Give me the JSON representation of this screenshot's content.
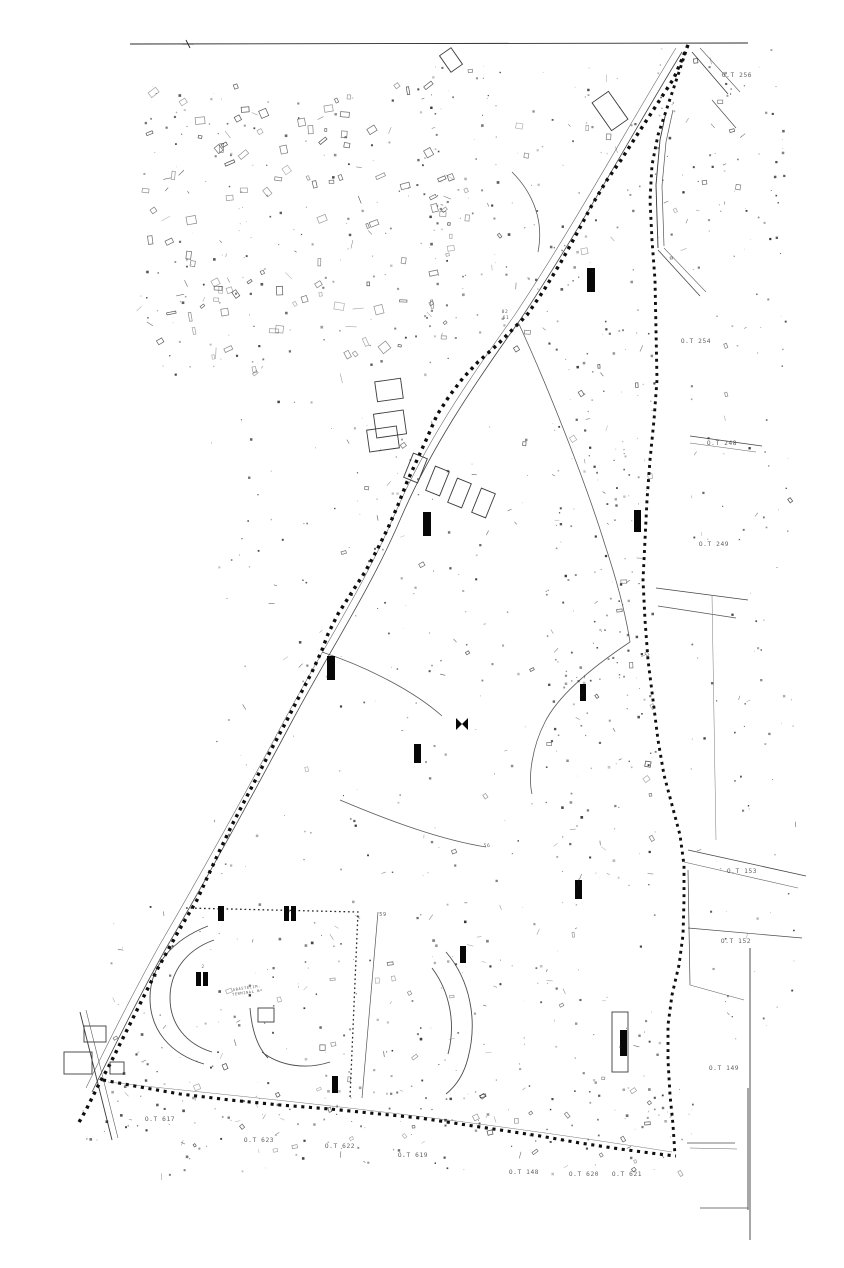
{
  "page": {
    "background": "#ffffff",
    "ink": "#0e0e0e",
    "road_color": "#3a3a3a",
    "label_color": "#4a4a4a"
  },
  "map": {
    "seed": 20240711,
    "boundaries": {
      "top_line": "M130,44 L748,43",
      "top_tick": "M186,40 L190,48 M182,44 L194,44",
      "main_diagonal": "M688,45 L674,78 L652,112 L637,135 L621,160 L607,180 L592,205 L576,235 L561,262 L544,290 L527,315 L512,330 L497,345 L478,362 L463,378 L450,395 L437,415 L427,438 L417,460 L407,482 L398,505 L388,528 L377,550 L365,572 L352,592 L338,614 L328,634 L322,650 L312,672 L300,695 L286,722 L272,748 L258,775 L245,800 L232,825 L219,852 L207,878 L197,900 L188,915 L178,932 L168,950 L158,968 L148,988 L138,1008 L128,1028 L118,1048 L108,1068 L100,1082 L93,1096 L86,1110 L78,1124",
      "right_edge": "M688,45 L678,75 L668,105 L658,135 L652,165 L650,200 L652,240 L655,280 L656,330 L657,380 L654,420 L650,460 L647,500 L645,540 L643,580 L645,620 L648,660 L653,700 L658,740 L664,775 L672,805 L680,835 L684,865 L684,900 L683,935 L679,965 L672,995 L668,1025 L668,1060 L670,1095 L673,1125 L675,1155",
      "bottom_edge": "M103,1080 L140,1087 L180,1094 L230,1100 L280,1105 L330,1109 L380,1114 L420,1118 L460,1124 L500,1130 L540,1136 L580,1143 L620,1149 L658,1154 L676,1156",
      "stadium_fence": "M186,908 L358,912 L350,1098"
    },
    "roads": [
      {
        "name": "diagonal-road-west-1",
        "d": "M682,52 C640,120 580,230 520,320 C470,390 430,450 400,520 C370,590 330,650 290,725 C250,800 200,890 165,950 C140,995 110,1055 92,1092",
        "w": 0.8,
        "c": "#474747"
      },
      {
        "name": "diagonal-road-west-2",
        "d": "M676,48 C634,116 574,226 514,316 C464,386 424,446 394,516 C364,586 324,646 284,721 C244,796 194,886 159,946 C134,991 104,1051 86,1088",
        "w": 0.6,
        "c": "#6a6a6a"
      },
      {
        "name": "right-road-vert-1",
        "d": "M666,112 L660,140 L656,185 L658,248",
        "w": 0.9,
        "c": "#3a3a3a"
      },
      {
        "name": "right-road-vert-2",
        "d": "M673,110 L666,142 L662,186 L664,246",
        "w": 0.7,
        "c": "#555555"
      },
      {
        "name": "right-road-bend-1",
        "d": "M658,250 L700,296",
        "w": 0.8,
        "c": "#4a4a4a"
      },
      {
        "name": "right-road-bend-2",
        "d": "M664,248 L706,292",
        "w": 0.6,
        "c": "#666666"
      },
      {
        "name": "topright-diag-1",
        "d": "M692,52 L728,94",
        "w": 0.8,
        "c": "#3f3f3f"
      },
      {
        "name": "topright-diag-2",
        "d": "M700,48 L740,92",
        "w": 0.6,
        "c": "#5f5f5f"
      },
      {
        "name": "topright-diag-3",
        "d": "M712,100 L736,128",
        "w": 0.7,
        "c": "#4f4f4f"
      },
      {
        "name": "street-248-1",
        "d": "M690,436 L762,446",
        "w": 0.8,
        "c": "#454545"
      },
      {
        "name": "street-248-2",
        "d": "M690,443 L756,452",
        "w": 0.6,
        "c": "#656565"
      },
      {
        "name": "street-249-fork-1",
        "d": "M656,588 L748,600",
        "w": 0.8,
        "c": "#454545"
      },
      {
        "name": "street-249-fork-2",
        "d": "M658,606 L736,618",
        "w": 0.7,
        "c": "#555555"
      },
      {
        "name": "right-vert-mid",
        "d": "M712,595 L716,840",
        "w": 0.5,
        "c": "#777777"
      },
      {
        "name": "street-153-diag-1",
        "d": "M688,850 L806,876",
        "w": 0.8,
        "c": "#454545"
      },
      {
        "name": "street-153-diag-2",
        "d": "M684,862 L798,888",
        "w": 0.6,
        "c": "#606060"
      },
      {
        "name": "street-152-vert",
        "d": "M688,870 L690,985",
        "w": 0.7,
        "c": "#4d4d4d"
      },
      {
        "name": "street-152-horiz",
        "d": "M688,928 L802,938",
        "w": 0.7,
        "c": "#4d4d4d"
      },
      {
        "name": "street-152-diag",
        "d": "M690,985 L744,1000",
        "w": 0.6,
        "c": "#606060"
      },
      {
        "name": "neatline-right-vert",
        "d": "M750,948 L750,1240",
        "w": 0.9,
        "c": "#3c3c3c"
      },
      {
        "name": "frame-h1",
        "d": "M687,1143 L735,1143",
        "w": 0.8,
        "c": "#4a4a4a"
      },
      {
        "name": "frame-h2",
        "d": "M690,1148 L737,1149",
        "w": 0.6,
        "c": "#6a6a6a"
      },
      {
        "name": "frame-h3",
        "d": "M700,1208 L748,1208",
        "w": 0.8,
        "c": "#4a4a4a"
      },
      {
        "name": "frame-v",
        "d": "M748,1088 L748,1210",
        "w": 0.9,
        "c": "#3c3c3c"
      },
      {
        "name": "bottomleft-cross-1",
        "d": "M80,1012 L112,1140",
        "w": 0.9,
        "c": "#3c3c3c"
      },
      {
        "name": "bottomleft-cross-2",
        "d": "M86,1010 L118,1138",
        "w": 0.6,
        "c": "#606060"
      },
      {
        "name": "bottom-echo",
        "d": "M108,1082 C250,1098 420,1112 672,1152",
        "w": 0.5,
        "c": "#787878"
      },
      {
        "name": "stadium-cut-line",
        "d": "M378,912 L362,1098",
        "w": 0.7,
        "c": "#555555"
      }
    ],
    "curves": [
      {
        "name": "stream-upper",
        "d": "M518,322 C545,380 585,480 605,545 C615,575 625,610 630,642"
      },
      {
        "name": "stream-lower",
        "d": "M630,642 C600,662 560,692 545,722 C532,747 528,777 532,794"
      },
      {
        "name": "path-mid-1",
        "d": "M322,652 C370,668 415,692 442,716"
      },
      {
        "name": "path-mid-2",
        "d": "M340,800 C392,822 442,840 486,847"
      },
      {
        "name": "path-top",
        "d": "M512,172 C534,194 544,222 538,252"
      }
    ],
    "stadium_arcs": [
      "M208,926 C172,940 150,966 150,998 C150,1030 170,1054 204,1064",
      "M214,940 C186,950 170,972 170,998 C170,1024 186,1044 212,1052",
      "M446,952 C470,980 478,1020 468,1058 C464,1074 456,1086 446,1094",
      "M432,968 C450,992 456,1024 448,1054",
      "M262,1052 C280,1066 306,1070 330,1062",
      "M250,1008 C252,1032 258,1048 268,1058"
    ],
    "building_bars": [
      [
        587,
        268,
        8,
        24
      ],
      [
        423,
        512,
        8,
        24
      ],
      [
        634,
        510,
        7,
        22
      ],
      [
        327,
        656,
        8,
        24
      ],
      [
        580,
        684,
        6,
        17
      ],
      [
        414,
        744,
        7,
        19
      ],
      [
        575,
        880,
        7,
        19
      ],
      [
        284,
        906,
        5,
        15
      ],
      [
        291,
        906,
        5,
        15
      ],
      [
        218,
        906,
        6,
        15
      ],
      [
        196,
        972,
        5,
        14
      ],
      [
        203,
        972,
        5,
        14
      ],
      [
        460,
        946,
        6,
        17
      ],
      [
        332,
        1076,
        6,
        17
      ],
      [
        620,
        1030,
        7,
        26
      ]
    ],
    "bowtie": {
      "x": 462,
      "y": 724,
      "half": 6,
      "spread": 6
    },
    "outline_buildings": [
      {
        "x": 376,
        "y": 380,
        "w": 26,
        "h": 20,
        "r": -8
      },
      {
        "x": 375,
        "y": 412,
        "w": 30,
        "h": 24,
        "r": -8
      },
      {
        "x": 368,
        "y": 428,
        "w": 30,
        "h": 22,
        "r": -8
      },
      {
        "x": 408,
        "y": 455,
        "w": 15,
        "h": 26,
        "r": 22
      },
      {
        "x": 430,
        "y": 468,
        "w": 15,
        "h": 26,
        "r": 22
      },
      {
        "x": 452,
        "y": 480,
        "w": 15,
        "h": 26,
        "r": 22
      },
      {
        "x": 476,
        "y": 490,
        "w": 15,
        "h": 26,
        "r": 22
      },
      {
        "x": 84,
        "y": 1026,
        "w": 22,
        "h": 16,
        "r": 0
      },
      {
        "x": 64,
        "y": 1052,
        "w": 28,
        "h": 22,
        "r": 0
      },
      {
        "x": 110,
        "y": 1062,
        "w": 14,
        "h": 12,
        "r": 0
      },
      {
        "x": 258,
        "y": 1008,
        "w": 16,
        "h": 14,
        "r": 0
      },
      {
        "x": 612,
        "y": 1012,
        "w": 16,
        "h": 60,
        "r": 0
      },
      {
        "x": 444,
        "y": 50,
        "w": 14,
        "h": 20,
        "r": -35
      },
      {
        "x": 600,
        "y": 94,
        "w": 20,
        "h": 34,
        "r": -35
      }
    ],
    "labels": [
      {
        "name": "parcel-label-ot-256",
        "text": "O.T 256",
        "x": 737,
        "y": 77,
        "fs": 6.2
      },
      {
        "name": "parcel-label-ot-254",
        "text": "O.T 254",
        "x": 696,
        "y": 343,
        "fs": 6.2
      },
      {
        "name": "parcel-label-ot-248",
        "text": "O.T 248",
        "x": 722,
        "y": 445,
        "fs": 6.2
      },
      {
        "name": "parcel-label-ot-249",
        "text": "O.T 249",
        "x": 714,
        "y": 546,
        "fs": 6.2
      },
      {
        "name": "parcel-label-ot-153",
        "text": "O.T 153",
        "x": 742,
        "y": 873,
        "fs": 6.2
      },
      {
        "name": "parcel-label-ot-152",
        "text": "O.T 152",
        "x": 736,
        "y": 943,
        "fs": 6.2
      },
      {
        "name": "parcel-label-ot-149",
        "text": "O.T 149",
        "x": 724,
        "y": 1070,
        "fs": 6.2
      },
      {
        "name": "parcel-label-ot-617",
        "text": "O.T 617",
        "x": 160,
        "y": 1121,
        "fs": 6.2
      },
      {
        "name": "parcel-label-ot-623",
        "text": "O.T 623",
        "x": 259,
        "y": 1142,
        "fs": 6.2
      },
      {
        "name": "parcel-label-ot-622",
        "text": "O.T 622",
        "x": 340,
        "y": 1148,
        "fs": 6.2
      },
      {
        "name": "parcel-label-ot-619",
        "text": "O.T 619",
        "x": 413,
        "y": 1157,
        "fs": 6.2
      },
      {
        "name": "parcel-label-ot-148",
        "text": "O.T 148",
        "x": 524,
        "y": 1174,
        "fs": 6.2
      },
      {
        "name": "parcel-label-ot-620",
        "text": "O.T 620",
        "x": 584,
        "y": 1176,
        "fs": 6.2
      },
      {
        "name": "parcel-label-ot-621",
        "text": "O.T 621",
        "x": 627,
        "y": 1176,
        "fs": 6.2
      }
    ],
    "tiny_labels": [
      {
        "name": "plot-number-02",
        "text": "02",
        "x": 505,
        "y": 313,
        "fs": 4.6
      },
      {
        "name": "plot-number-61",
        "text": "61",
        "x": 506,
        "y": 319,
        "fs": 4.6
      },
      {
        "name": "plot-number-59",
        "text": "59",
        "x": 383,
        "y": 916,
        "fs": 5.2
      },
      {
        "name": "plot-number-56",
        "text": "56",
        "x": 487,
        "y": 847,
        "fs": 4.6
      },
      {
        "name": "plot-number-2",
        "text": "2",
        "x": 203,
        "y": 968,
        "fs": 4.2
      }
    ],
    "stadium_note": {
      "line1": "ABASTECIM.",
      "line2": "TERMINAL Nº",
      "x": 247,
      "y": 989,
      "fs": 3.7,
      "rot": -8
    },
    "noise_regions": [
      {
        "x": 140,
        "y": 85,
        "w": 310,
        "h": 290,
        "count": 300,
        "max": 5,
        "rect": 0.3
      },
      {
        "x": 430,
        "y": 60,
        "w": 210,
        "h": 300,
        "count": 140,
        "max": 3,
        "rect": 0.1
      },
      {
        "x": 545,
        "y": 330,
        "w": 110,
        "h": 560,
        "count": 220,
        "max": 2.5,
        "rect": 0.08
      },
      {
        "x": 210,
        "y": 400,
        "w": 340,
        "h": 480,
        "count": 180,
        "max": 2,
        "rect": 0.05
      },
      {
        "x": 110,
        "y": 900,
        "w": 560,
        "h": 230,
        "count": 260,
        "max": 2.5,
        "rect": 0.08
      },
      {
        "x": 655,
        "y": 48,
        "w": 130,
        "h": 210,
        "count": 80,
        "max": 2.5,
        "rect": 0.1
      },
      {
        "x": 690,
        "y": 260,
        "w": 110,
        "h": 800,
        "count": 100,
        "max": 2,
        "rect": 0.05
      },
      {
        "x": 75,
        "y": 1085,
        "w": 620,
        "h": 90,
        "count": 140,
        "max": 2.5,
        "rect": 0.1
      }
    ]
  }
}
